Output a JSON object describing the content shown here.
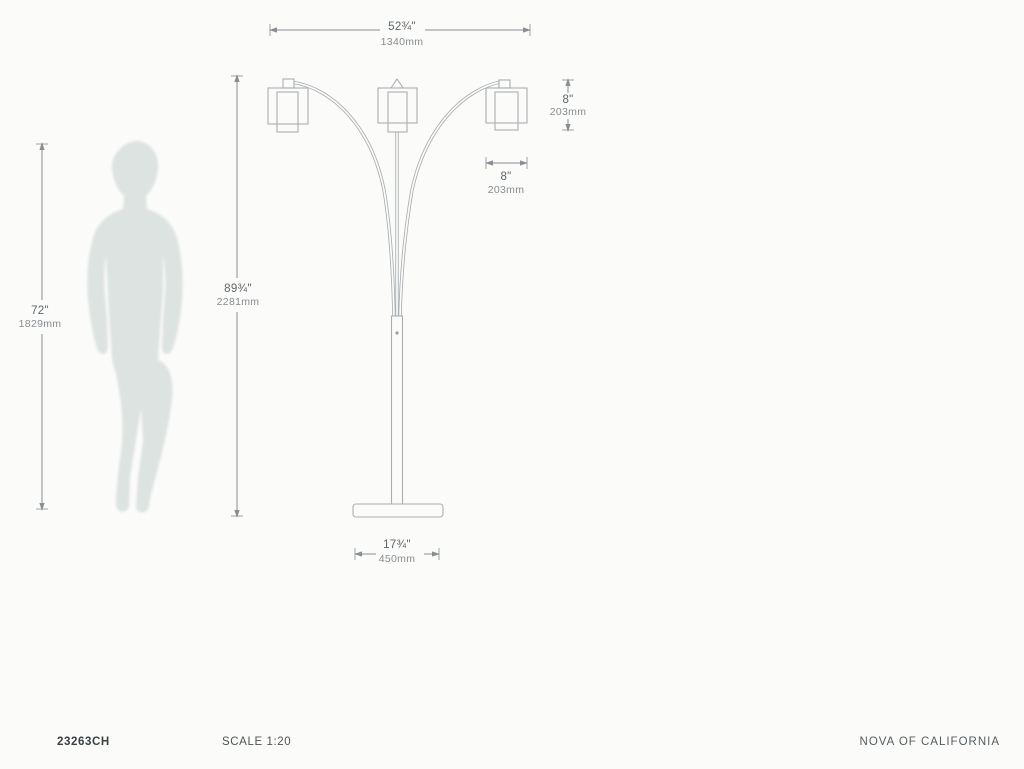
{
  "page": {
    "background": "#fbfbfa",
    "type": "product dimension drawing"
  },
  "drawing": {
    "product": "three-shade arc floor lamp with human figure for scale",
    "line_color": "#a9aeb1",
    "dim_color": "#888e91",
    "silhouette_color": "#dde3e1",
    "dimensions": {
      "overall_width": {
        "in": "52¾\"",
        "mm": "1340mm"
      },
      "shade_height": {
        "in": "8\"",
        "mm": "203mm"
      },
      "shade_width": {
        "in": "8\"",
        "mm": "203mm"
      },
      "lamp_height": {
        "in": "89¾\"",
        "mm": "2281mm"
      },
      "human_height": {
        "in": "72\"",
        "mm": "1829mm"
      },
      "base_width": {
        "in": "17¾\"",
        "mm": "450mm"
      }
    }
  },
  "footer": {
    "sku": "23263CH",
    "scale": "SCALE 1:20",
    "brand": "NOVA OF CALIFORNIA"
  }
}
